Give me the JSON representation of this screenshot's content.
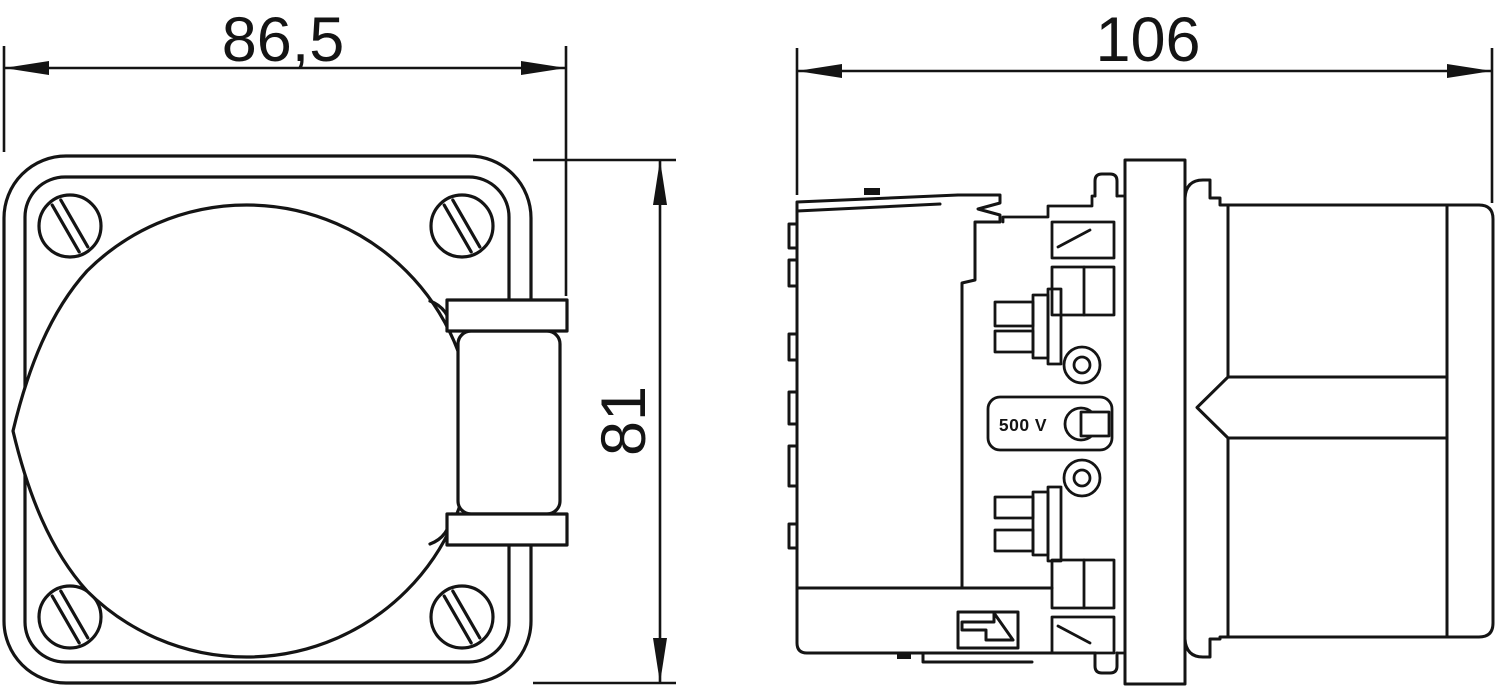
{
  "colors": {
    "background": "#ffffff",
    "line": "#141414"
  },
  "front_view": {
    "width_dimension": "86,5",
    "height_dimension": "81"
  },
  "side_view": {
    "depth_dimension": "106",
    "voltage_marking": "500 V"
  }
}
